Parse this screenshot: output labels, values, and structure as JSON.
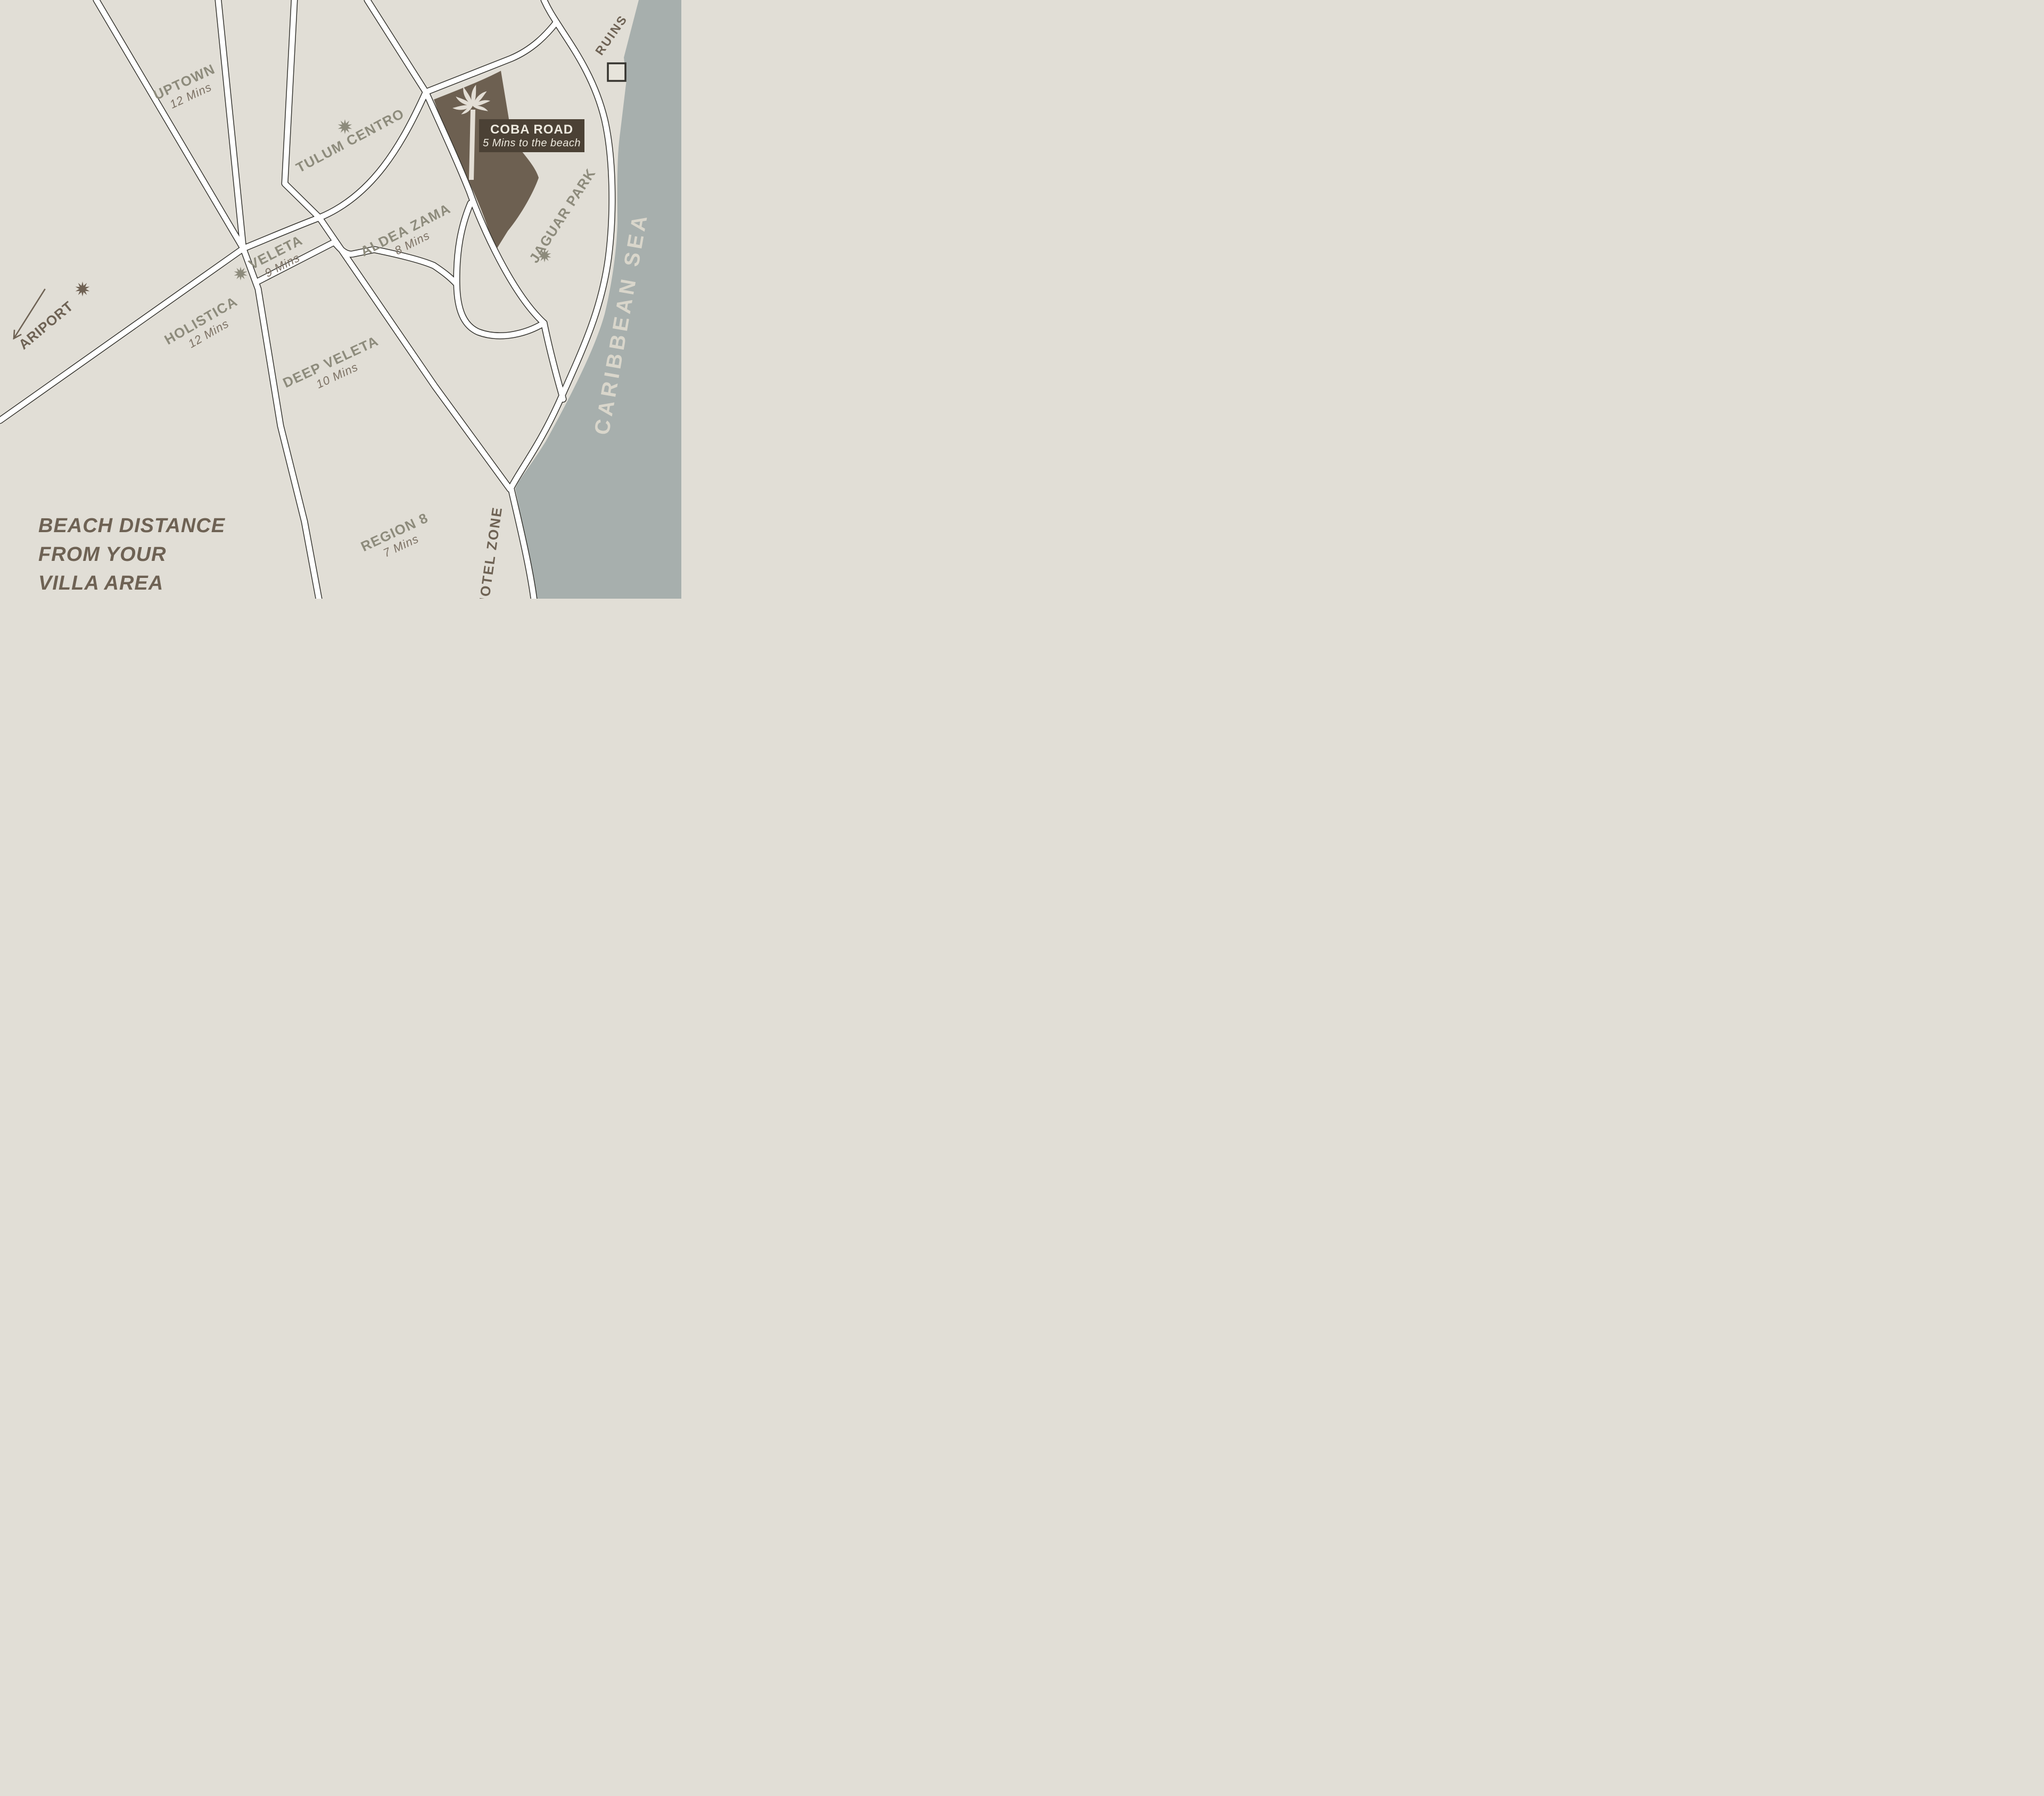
{
  "map": {
    "colors": {
      "land": "#e1ded6",
      "sea": "#a7afad",
      "road_fill": "#ffffff",
      "road_casing": "#35342f",
      "highlight": "#6d6051",
      "badge_bg": "#4b4135",
      "badge_text": "#eeeadf",
      "area_label": "#8d8b7c",
      "mins_label": "#7c7164",
      "poi_label": "#6e6254",
      "sea_label": "#d9d6cb"
    },
    "highlight_badge": {
      "title": "COBA ROAD",
      "subtitle": "5 Mins to the beach"
    },
    "areas": [
      {
        "id": "uptown",
        "label": "UPTOWN",
        "time": "12 Mins"
      },
      {
        "id": "tulum-centro",
        "label": "TULUM CENTRO"
      },
      {
        "id": "veleta",
        "label": "VELETA",
        "time": "9 Mins"
      },
      {
        "id": "aldea-zama",
        "label": "ALDEA ZAMA",
        "time": "8 Mins"
      },
      {
        "id": "holistica",
        "label": "HOLISTICA",
        "time": "12 Mins"
      },
      {
        "id": "deep-veleta",
        "label": "DEEP VELETA",
        "time": "10 Mins"
      },
      {
        "id": "region-8",
        "label": "REGION 8",
        "time": "7 Mins"
      },
      {
        "id": "jaguar-park",
        "label": "JAGUAR PARK"
      }
    ],
    "pois": {
      "airport": "ARIPORT",
      "ruins": "RUINS",
      "hotel_zone": "HOTEL ZONE",
      "sea_name": "CARIBBEAN SEA"
    },
    "legend": {
      "line1": "BEACH DISTANCE",
      "line2": "FROM YOUR",
      "line3": "VILLA AREA"
    }
  }
}
